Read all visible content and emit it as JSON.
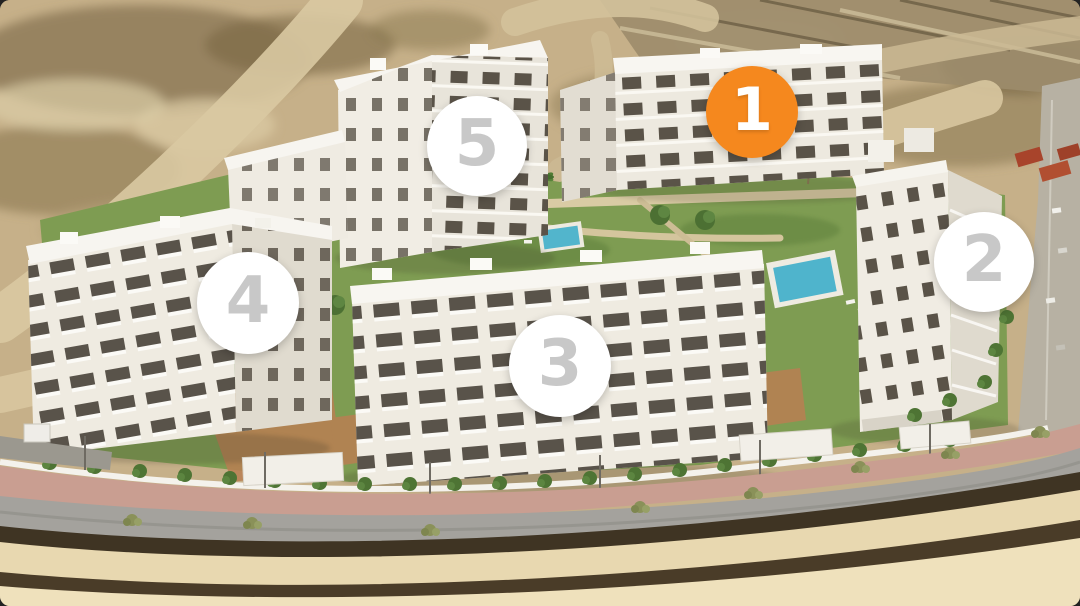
{
  "scene": {
    "description": "Aerial 3D render of a five-building residential complex with numbered circular building markers; building 1 is highlighted in orange"
  },
  "markers": [
    {
      "label": "1",
      "building": "building-1",
      "style": "highlighted-orange"
    },
    {
      "label": "2",
      "building": "building-2",
      "style": "white"
    },
    {
      "label": "3",
      "building": "building-3",
      "style": "white"
    },
    {
      "label": "4",
      "building": "building-4",
      "style": "white"
    },
    {
      "label": "5",
      "building": "building-5",
      "style": "white"
    }
  ],
  "colors": {
    "marker_highlight": "#F5881E",
    "marker_white": "#FFFFFF",
    "marker_digit_gray": "#C8C8C8",
    "marker_digit_white": "#FFFFFF",
    "terrain_tan": "#C6B089",
    "lawn_green": "#7E9C52",
    "pool_blue": "#52B5CC",
    "road_gray": "#A4A29D",
    "sidewalk_pink": "#C99E91",
    "building_white": "#EFEBE1"
  }
}
